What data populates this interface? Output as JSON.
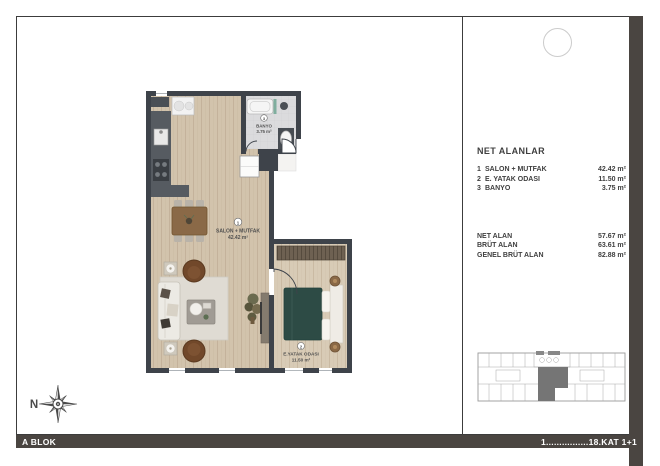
{
  "legend": {
    "title": "NET ALANLAR",
    "rooms": [
      {
        "num": "1",
        "name": "SALON + MUTFAK",
        "area": "42.42 m²"
      },
      {
        "num": "2",
        "name": "E. YATAK ODASI",
        "area": "11.50 m²"
      },
      {
        "num": "3",
        "name": "BANYO",
        "area": "3.75 m²"
      }
    ],
    "totals": [
      {
        "label": "NET ALAN",
        "value": "57.67 m²"
      },
      {
        "label": "BRÜT ALAN",
        "value": "63.61 m²"
      },
      {
        "label": "GENEL BRÜT ALAN",
        "value": "82.88 m²"
      }
    ]
  },
  "plan": {
    "salon": {
      "num": "1",
      "name": "SALON + MUTFAK",
      "area": "42.42 m²"
    },
    "bedroom": {
      "num": "2",
      "name": "E.YATAK ODASI",
      "area": "11.50 m²"
    },
    "bath": {
      "num": "3",
      "name": "BANYO",
      "area": "3.75 m²"
    },
    "compass_label": "N"
  },
  "footer": {
    "block": "A BLOK",
    "floors": "1................18.KAT 1+1"
  },
  "colors": {
    "bar": "#4a4541",
    "wall": "#3e434a",
    "wood_floor": "#d2c3ac",
    "bedroom_floor": "#d8cbb6",
    "bath_floor": "#dbdbdd",
    "bed": "#2d4b45",
    "armchair": "#71482a",
    "keyplan_highlight": "#757575",
    "text": "#3f3f3f"
  }
}
